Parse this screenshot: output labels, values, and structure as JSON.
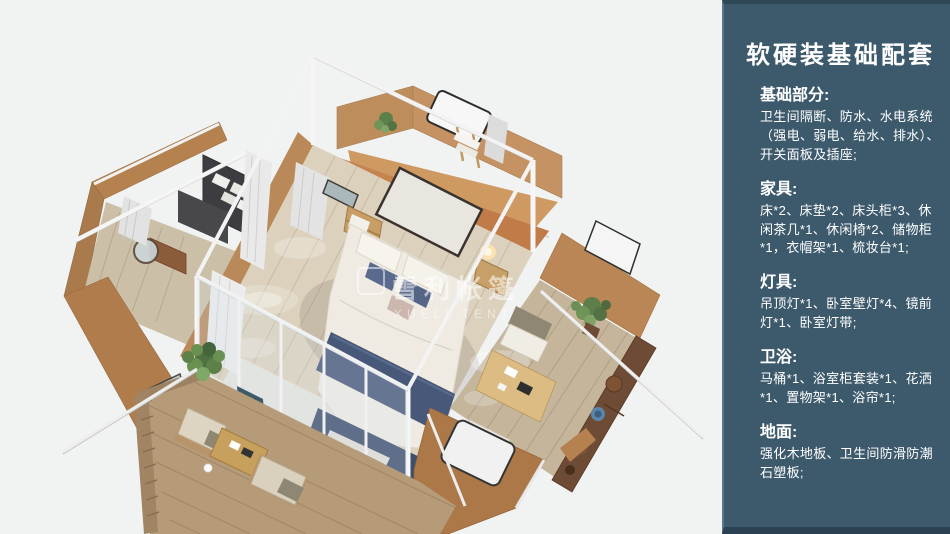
{
  "panel": {
    "title": "软硬装基础配套",
    "sections": [
      {
        "heading": "基础部分:",
        "body": "卫生间隔断、防水、水电系统（强电、弱电、给水、排水）、开关面板及插座;"
      },
      {
        "heading": "家具:",
        "body": "床*2、床垫*2、床头柜*3、休闲茶几*1、休闲椅*2、储物柜*1，衣帽架*1、梳妆台*1;"
      },
      {
        "heading": "灯具:",
        "body": "吊顶灯*1、卧室壁灯*4、镜前灯*1、卧室灯带;"
      },
      {
        "heading": "卫浴:",
        "body": "马桶*1、浴室柜套装*1、花洒*1、置物架*1、浴帘*1;"
      },
      {
        "heading": "地面:",
        "body": "强化木地板、卫生间防滑防潮石塑板;"
      }
    ],
    "colors": {
      "background": "#3d5a6c",
      "top_band": "#2e4857",
      "bottom_band": "#2a4253",
      "left_highlight": "#5d7689",
      "text": "#ffffff"
    }
  },
  "render": {
    "background_color": "#f1f2f2",
    "watermark_cn": "雪利帐篷",
    "watermark_en": "XUELI TENT"
  }
}
